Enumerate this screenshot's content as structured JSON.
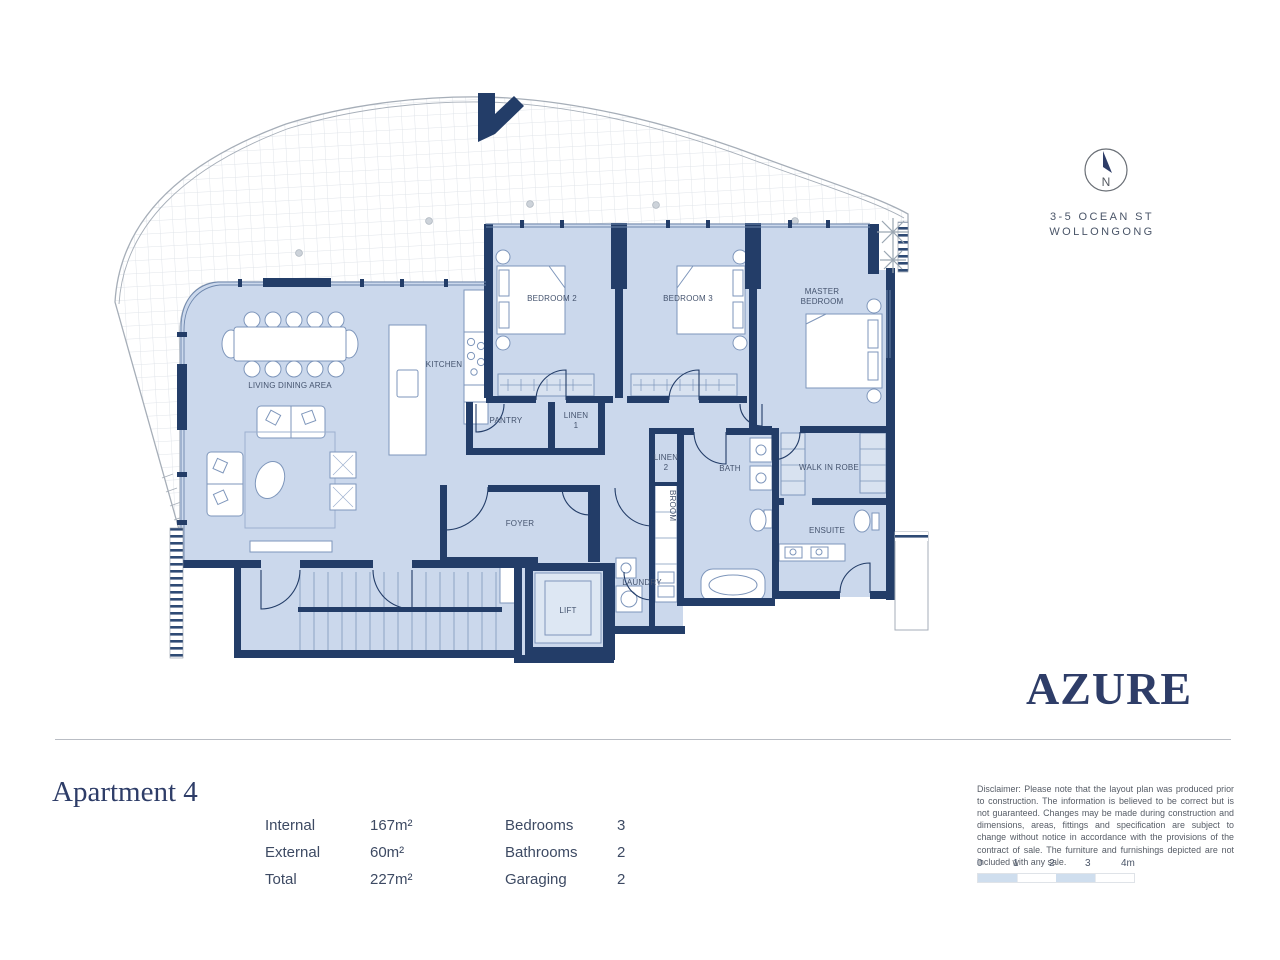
{
  "branding": {
    "logo": "AZURE",
    "address_line1": "3-5 OCEAN ST",
    "address_line2": "WOLLONGONG",
    "compass_label": "N"
  },
  "apartment": {
    "title": "Apartment 4",
    "areas": [
      {
        "label": "Internal",
        "value": "167m²"
      },
      {
        "label": "External",
        "value": "60m²"
      },
      {
        "label": "Total",
        "value": "227m²"
      }
    ],
    "counts": [
      {
        "label": "Bedrooms",
        "value": "3"
      },
      {
        "label": "Bathrooms",
        "value": "2"
      },
      {
        "label": "Garaging",
        "value": "2"
      }
    ]
  },
  "rooms": {
    "living": "LIVING DINING AREA",
    "kitchen": "KITCHEN",
    "pantry": "PANTRY",
    "linen1_a": "LINEN",
    "linen1_b": "1",
    "bedroom2": "BEDROOM 2",
    "bedroom3": "BEDROOM 3",
    "master_a": "MASTER",
    "master_b": "BEDROOM",
    "linen2_a": "LINEN",
    "linen2_b": "2",
    "bath": "BATH",
    "walk_in_robe": "WALK IN ROBE",
    "broom": "BROOM",
    "ensuite": "ENSUITE",
    "laundry": "LAUNDRY",
    "foyer": "FOYER",
    "lift": "LIFT"
  },
  "disclaimer": "Disclaimer: Please note that the layout plan was produced prior to construction. The information is believed to be correct but is not guaranteed. Changes may be made during construction and dimensions, areas, fittings and specification are subject to change without notice in accordance with the provisions of the contract of sale. The furniture and furnishings depicted are not included with any sale.",
  "scale_ticks": [
    "0",
    "1",
    "2",
    "3",
    "4m"
  ],
  "colors": {
    "wall": "#233d68",
    "floor": "#cbd8ec",
    "accent_navy": "#2e3d68",
    "scale_blue": "#cfdeee"
  }
}
